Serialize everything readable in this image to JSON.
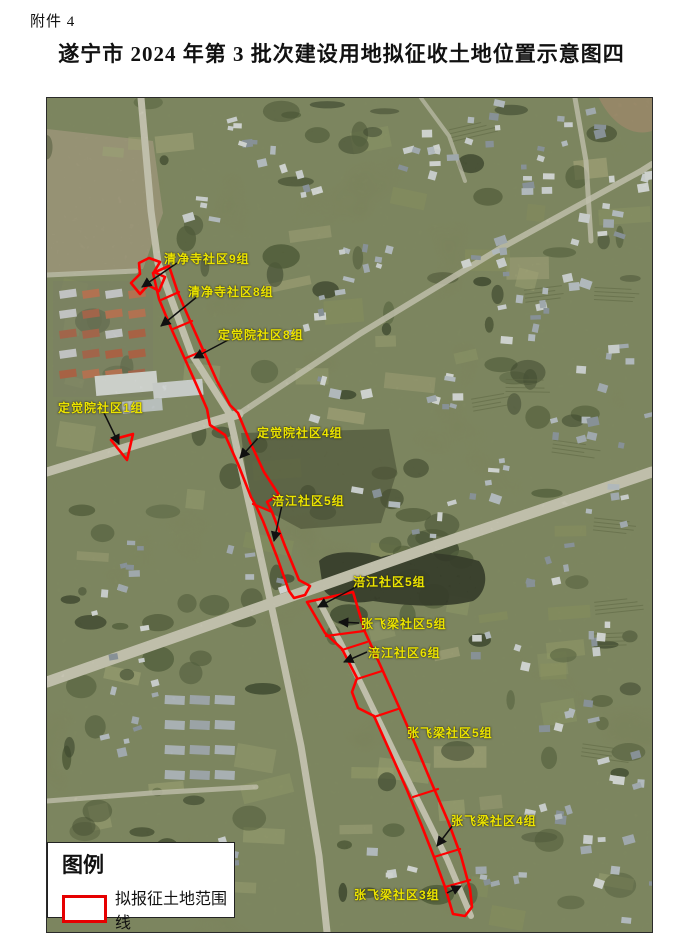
{
  "page": {
    "attachment_label": "附件 4",
    "title": "遂宁市 2024 年第 3 批次建设用地拟征收土地位置示意图四"
  },
  "legend": {
    "heading": "图例",
    "items": [
      {
        "swatch_color": "#e60000",
        "label": "拟报征土地范围线"
      }
    ]
  },
  "map": {
    "kind": "satellite-annotated-parcel-map",
    "boundary_color": "#ff0000",
    "label_color": "#ece400",
    "labels": [
      {
        "text": "清净寺社区9组",
        "x": 163,
        "y": 249,
        "arrow": [
          176,
          262,
          141,
          286
        ]
      },
      {
        "text": "清净寺社区8组",
        "x": 187,
        "y": 282,
        "arrow": [
          197,
          295,
          160,
          325
        ]
      },
      {
        "text": "定觉院社区8组",
        "x": 217,
        "y": 325,
        "arrow": [
          229,
          338,
          193,
          357
        ]
      },
      {
        "text": "定觉院社区1组",
        "x": 57,
        "y": 398,
        "arrow": [
          103,
          412,
          118,
          443
        ]
      },
      {
        "text": "定觉院社区4组",
        "x": 256,
        "y": 423,
        "arrow": [
          258,
          436,
          239,
          457
        ]
      },
      {
        "text": "涪江社区5组",
        "x": 271,
        "y": 491,
        "arrow": [
          281,
          504,
          273,
          540
        ]
      },
      {
        "text": "涪江社区5组",
        "x": 352,
        "y": 572,
        "arrow": [
          357,
          585,
          317,
          606
        ]
      },
      {
        "text": "张飞梁社区5组",
        "x": 360,
        "y": 614,
        "arrow": [
          358,
          622,
          338,
          621
        ]
      },
      {
        "text": "涪江社区6组",
        "x": 367,
        "y": 643,
        "arrow": [
          366,
          651,
          343,
          661
        ]
      },
      {
        "text": "张飞梁社区5组",
        "x": 406,
        "y": 723,
        "arrow": null
      },
      {
        "text": "张飞梁社区4组",
        "x": 450,
        "y": 811,
        "arrow": [
          452,
          824,
          436,
          845
        ]
      },
      {
        "text": "张飞梁社区3组",
        "x": 353,
        "y": 885,
        "arrow": [
          446,
          892,
          460,
          885
        ]
      }
    ]
  }
}
